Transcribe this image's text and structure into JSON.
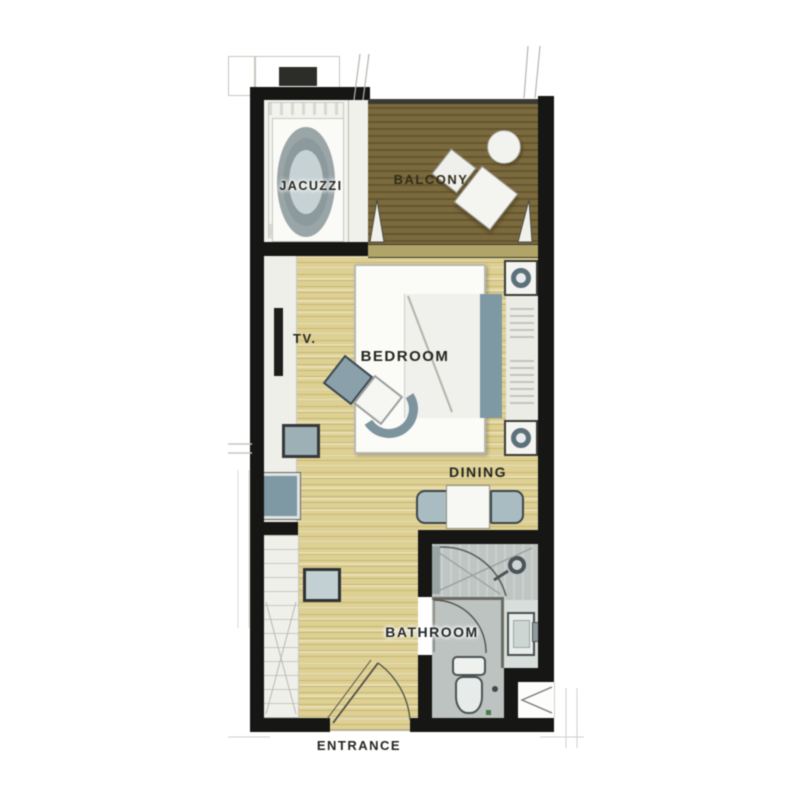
{
  "colors": {
    "wall": "#161614",
    "wood": "#ddd092",
    "deck": "#7b6a3d",
    "deck-stripe": "#665630",
    "tile": "#f2f2ee",
    "fixture": "#8fa5ad",
    "fixture-dark": "#5c7179",
    "fixture-light": "#c6d2d4",
    "bath-floor": "#c4cbc8",
    "porcelain": "#f0f2ef",
    "label": "#26261f",
    "line-faint": "#c6c6bf"
  },
  "labels": {
    "jacuzzi": "JACUZZI",
    "balcony": "BALCONY",
    "tv": "TV.",
    "bedroom": "BEDROOM",
    "dining": "DINING",
    "bathroom": "BATHROOM",
    "entrance": "ENTRANCE"
  }
}
